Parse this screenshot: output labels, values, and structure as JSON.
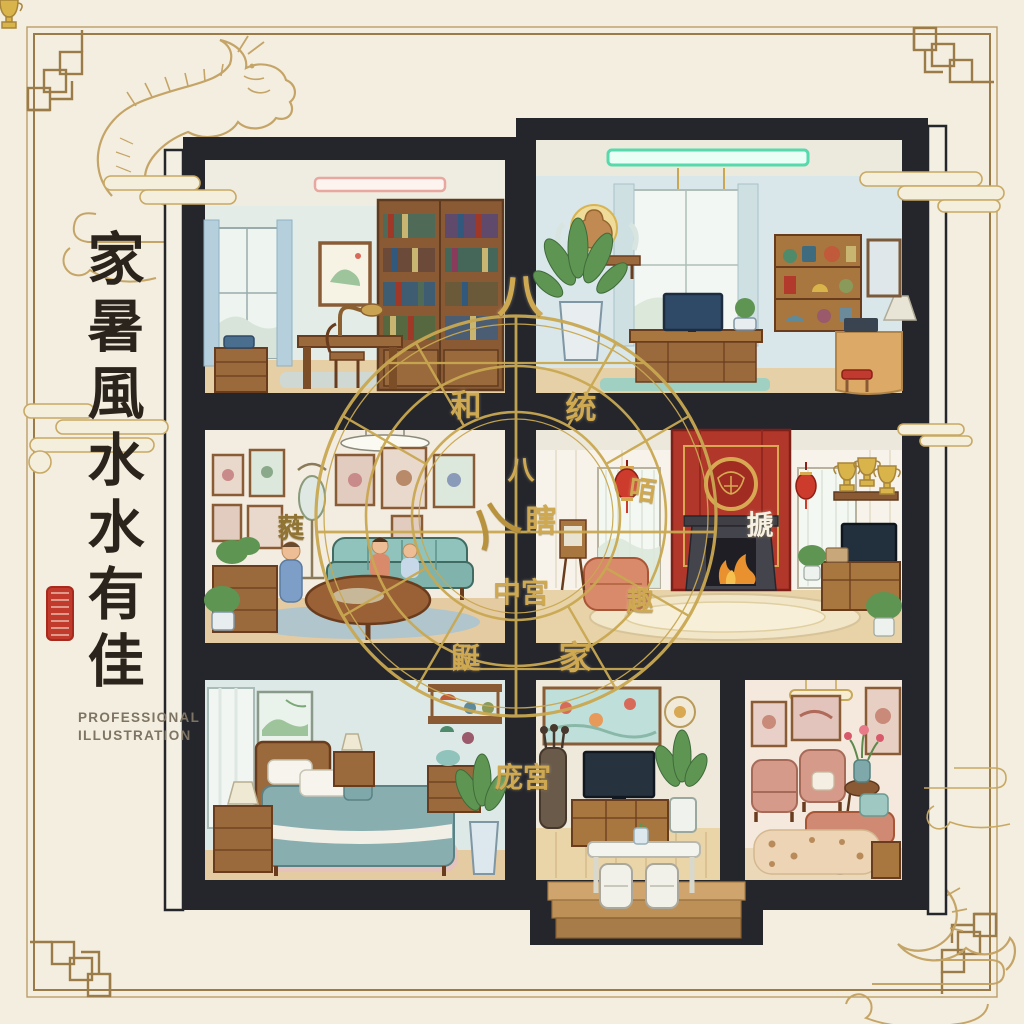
{
  "artwork": {
    "calligraphy_vertical_text": "家暑風水水有佳",
    "calligraphy_characters": [
      "家",
      "暑",
      "風",
      "水",
      "水",
      "有",
      "佳"
    ],
    "subtitle_lines": [
      "PROFESSIONAL",
      "ILLUSTRATION"
    ]
  },
  "bagua": {
    "labels": [
      {
        "text": "八",
        "x": 520,
        "y": 293,
        "size": 46,
        "rot": 0,
        "color": "#cfa952"
      },
      {
        "text": "和",
        "x": 466,
        "y": 403,
        "size": 31,
        "rot": 0,
        "color": "#cfa952"
      },
      {
        "text": "统",
        "x": 581,
        "y": 405,
        "size": 31,
        "rot": 0,
        "color": "#cfa952"
      },
      {
        "text": "八",
        "x": 521,
        "y": 468,
        "size": 27,
        "rot": 0,
        "color": "#cfa952"
      },
      {
        "text": "八",
        "x": 492,
        "y": 521,
        "size": 46,
        "rot": -28,
        "color": "#b8923c"
      },
      {
        "text": "瞎",
        "x": 541,
        "y": 518,
        "size": 31,
        "rot": 0,
        "color": "#cfa952"
      },
      {
        "text": "咟",
        "x": 643,
        "y": 488,
        "size": 27,
        "rot": 8,
        "color": "#cfa952"
      },
      {
        "text": "搋",
        "x": 760,
        "y": 523,
        "size": 27,
        "rot": 0,
        "color": "#f6f1e2"
      },
      {
        "text": "中宮",
        "x": 521,
        "y": 591,
        "size": 28,
        "rot": 0,
        "color": "#cfa952"
      },
      {
        "text": "趣",
        "x": 640,
        "y": 599,
        "size": 27,
        "rot": 0,
        "color": "#cfa952"
      },
      {
        "text": "鼮",
        "x": 466,
        "y": 656,
        "size": 29,
        "rot": 0,
        "color": "#cfa952"
      },
      {
        "text": "家",
        "x": 575,
        "y": 655,
        "size": 33,
        "rot": 0,
        "color": "#cfa952"
      },
      {
        "text": "庞宮",
        "x": 523,
        "y": 776,
        "size": 28,
        "rot": 0,
        "color": "#cfa952"
      },
      {
        "text": "蕤",
        "x": 291,
        "y": 526,
        "size": 27,
        "rot": 0,
        "color": "#8f7433"
      }
    ]
  },
  "illustration": {
    "rooms": [
      "study-library",
      "meditation-computer-room",
      "family-living-room",
      "fireplace-lounge",
      "bedroom",
      "tv-room",
      "sitting-room"
    ]
  },
  "palette": {
    "paper": "#f3eedf",
    "frame_gold": "#9b7b47",
    "line_gold": "#c3a161",
    "wall_black": "#24262c",
    "circle_gold": "#c9a851",
    "label_gold": "#cfa952",
    "accent_red": "#b2372b",
    "lantern_red": "#cc3b2c",
    "seal_red": "#c23a2c",
    "teal": "#8fc3bb",
    "wood": "#9a6a3c"
  }
}
